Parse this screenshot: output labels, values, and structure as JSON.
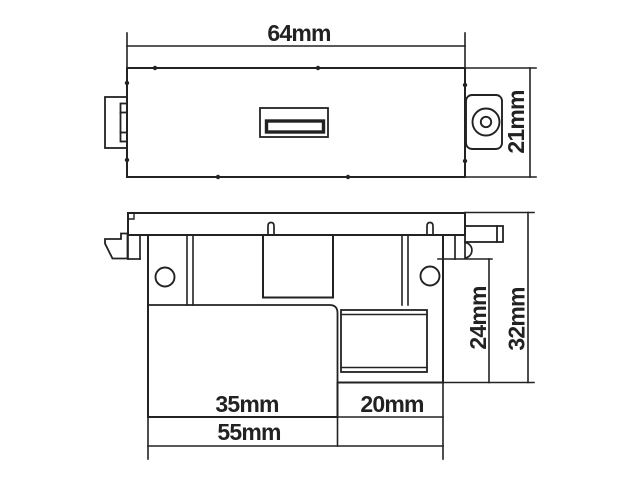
{
  "background_color": "#ffffff",
  "line_color": "#222222",
  "drawing": {
    "type": "technical-drawing",
    "unit": "mm",
    "front_view": {
      "width_label": "64mm",
      "height_label": "21mm"
    },
    "rear_view": {
      "body_width_label": "35mm",
      "connector_width_label": "20mm",
      "total_width_label": "55mm",
      "inner_depth_label": "24mm",
      "total_depth_label": "32mm"
    }
  }
}
